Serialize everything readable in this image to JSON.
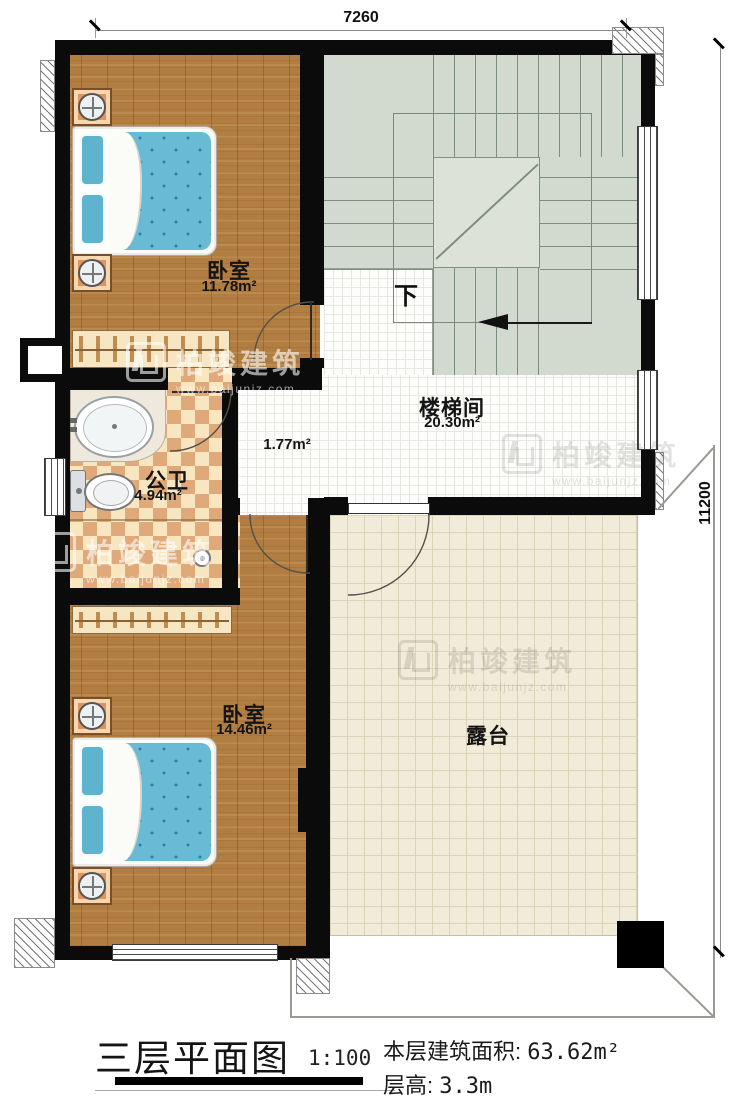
{
  "dimensions": {
    "top": "7260",
    "right": "11200"
  },
  "rooms": {
    "bedroom1": {
      "name": "卧室",
      "area": "11.78m²"
    },
    "stairwell": {
      "name": "楼梯间",
      "area": "20.30m²"
    },
    "corridor": {
      "area": "1.77m²"
    },
    "bathroom": {
      "name": "公卫",
      "area": "4.94m²"
    },
    "bedroom2": {
      "name": "卧室",
      "area": "14.46m²"
    },
    "terrace": {
      "name": "露台"
    }
  },
  "stairs": {
    "direction_label": "下"
  },
  "watermark": {
    "brand": "柏竣建筑",
    "site": "www.baijunjz.com"
  },
  "title_block": {
    "title": "三层平面图",
    "scale": "1:100",
    "floor_area_label": "本层建筑面积:",
    "floor_area_value": "63.62m²",
    "floor_height_label": "层高:",
    "floor_height_value": "3.3m"
  },
  "colors": {
    "wall": "#0b0b0b",
    "wood_floor": "#b17d41",
    "bathroom_tile": "#dfa97a",
    "stair_floor": "#d2dad0",
    "terrace_tile": "#f1ecd9",
    "bed_mattress": "#68bad5",
    "nightstand": "#e0935f"
  }
}
